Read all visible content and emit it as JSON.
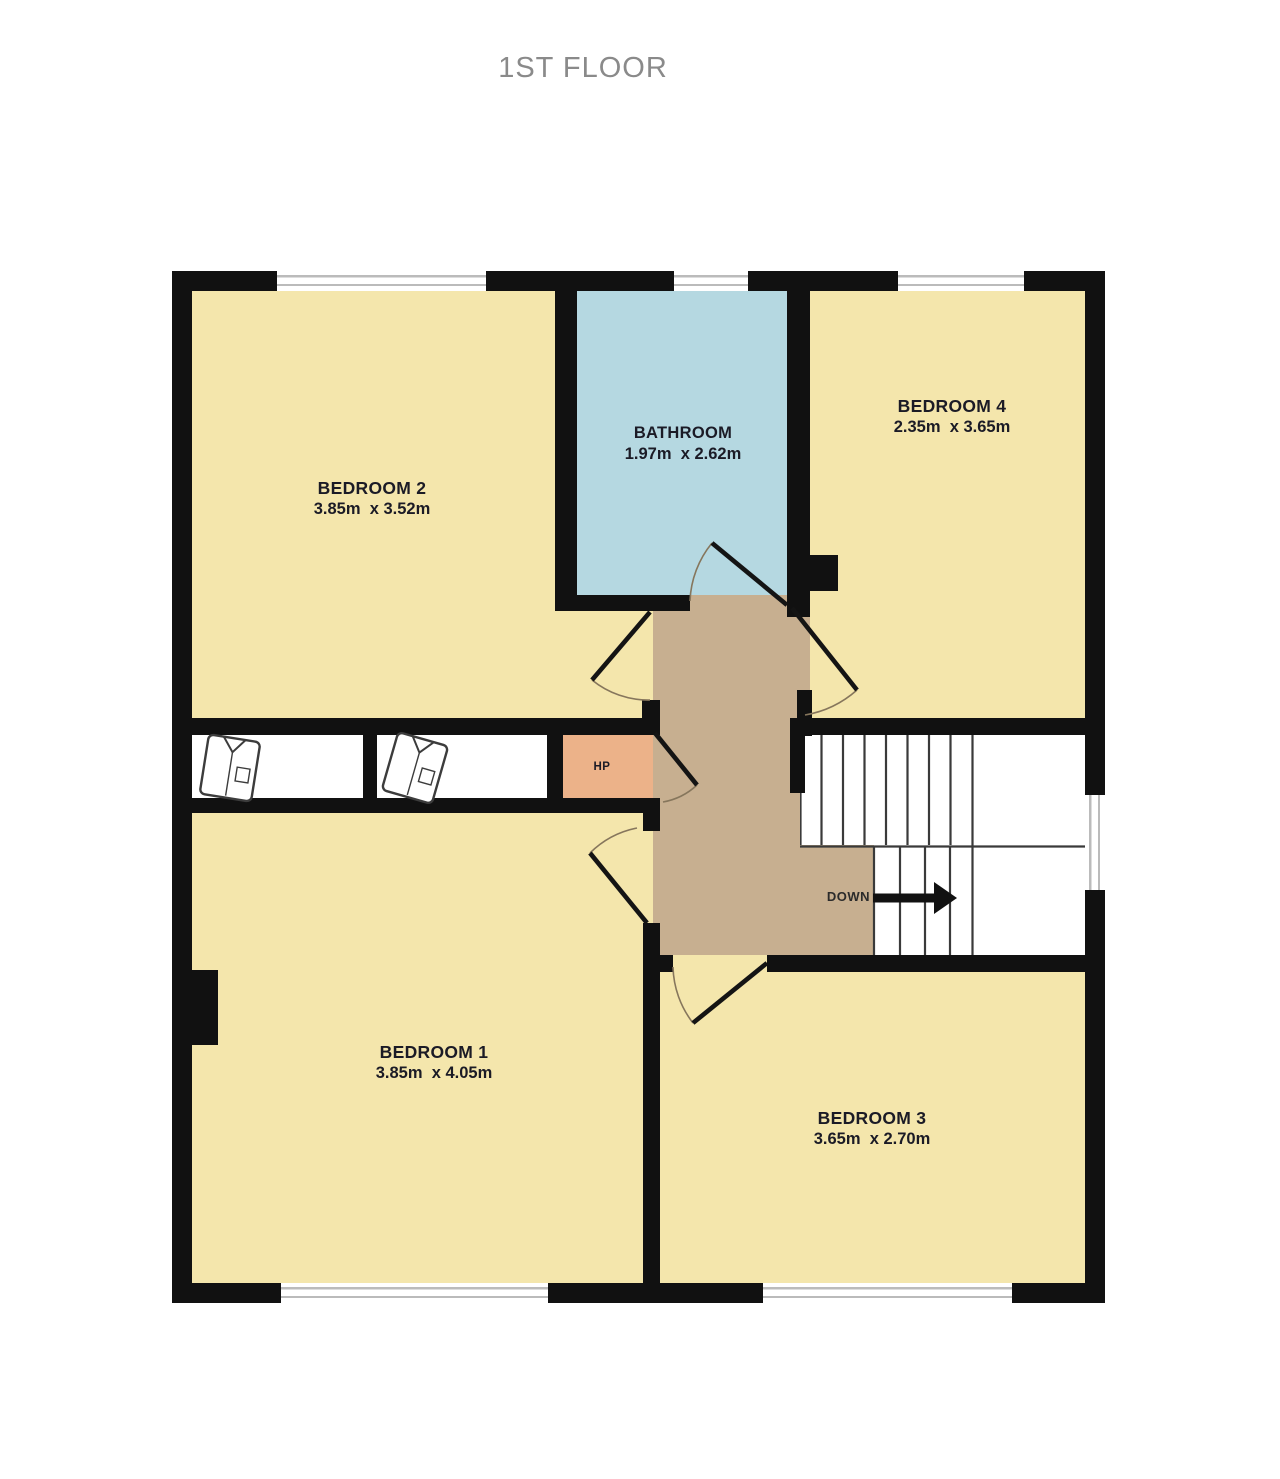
{
  "title": "1ST FLOOR",
  "colors": {
    "wall": "#111111",
    "floor": "#F4E6AC",
    "bathroom": "#B5D8E1",
    "landing": "#C7AF90",
    "hot_press": "#ECB289",
    "window_line": "#BBBBBB",
    "label_text": "#1B1B26",
    "title_text": "#8A8A8A"
  },
  "rooms": {
    "bedroom2": {
      "name": "BEDROOM 2",
      "dims": "3.85m  x 3.52m"
    },
    "bathroom": {
      "name": "BATHROOM",
      "dims": "1.97m  x 2.62m"
    },
    "bedroom4": {
      "name": "BEDROOM 4",
      "dims": "2.35m  x 3.65m"
    },
    "bedroom1": {
      "name": "BEDROOM 1",
      "dims": "3.85m  x 4.05m"
    },
    "bedroom3": {
      "name": "BEDROOM 3",
      "dims": "3.65m  x 2.70m"
    },
    "hot_press": {
      "name": "HP"
    }
  },
  "stairs": {
    "direction_label": "DOWN"
  }
}
